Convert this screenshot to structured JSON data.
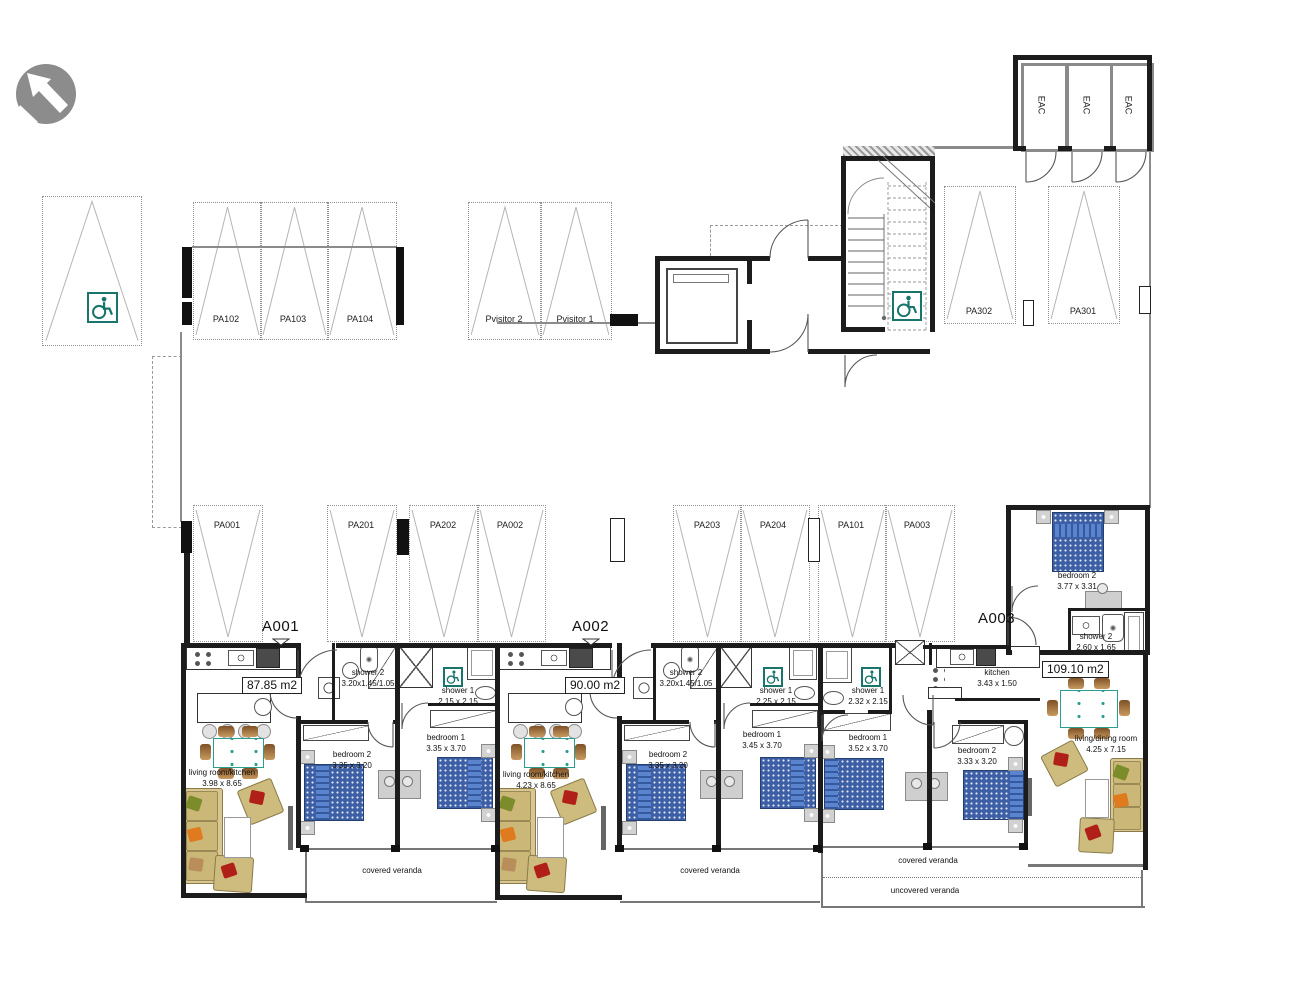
{
  "title": "ground floor plan with parking and apartments",
  "colors": {
    "accessible_teal": "#17756b",
    "bed_blue": "#3d5fa5",
    "pillow_blue": "#5b84cf",
    "sofa_tan": "#d9c690",
    "table_teal": "#2a9d8f",
    "wall_black": "#1c1c1c",
    "logo_gray": "#8c8c8c"
  },
  "parking": {
    "top_row": {
      "pa102": "PA102",
      "pa103": "PA103",
      "pa104": "PA104",
      "pvisitor2": "Pvisitor 2",
      "pvisitor1": "Pvisitor 1",
      "pa302": "PA302",
      "pa301": "PA301"
    },
    "middle_row": {
      "pa001": "PA001",
      "pa201": "PA201",
      "pa202": "PA202",
      "pa002": "PA002",
      "pa203": "PA203",
      "pa204": "PA204",
      "pa101": "PA101",
      "pa003": "PA003"
    }
  },
  "storage": {
    "eac1": "EAC",
    "eac2": "EAC",
    "eac3": "EAC"
  },
  "apartments": {
    "a001": {
      "id": "A001",
      "area": "87.85 m2",
      "living": {
        "name": "living room/kitchen",
        "dims": "3.98 x 8.65"
      },
      "bedroom2": {
        "name": "bedroom 2",
        "dims": "3.35 x 3.20"
      },
      "bedroom1": {
        "name": "bedroom 1",
        "dims": "3.35 x 3.70"
      },
      "shower2": {
        "name": "shower 2",
        "dims": "3.20x1.45/1.05"
      },
      "shower1": {
        "name": "shower 1",
        "dims": "2.15 x 2.15"
      },
      "veranda": "covered veranda"
    },
    "a002": {
      "id": "A002",
      "area": "90.00 m2",
      "living": {
        "name": "living room/kitchen",
        "dims": "4.23 x 8.65"
      },
      "bedroom2": {
        "name": "bedroom 2",
        "dims": "3.35 x 3.20"
      },
      "bedroom1": {
        "name": "bedroom 1",
        "dims": "3.45 x 3.70"
      },
      "shower2": {
        "name": "shower 2",
        "dims": "3.20x1.45/1.05"
      },
      "shower1": {
        "name": "shower 1",
        "dims": "2.25 x 2.15"
      },
      "veranda": "covered veranda"
    },
    "a003": {
      "id": "A003",
      "area": "109.10 m2",
      "kitchen": {
        "name": "kitchen",
        "dims": "3.43 x 1.50"
      },
      "living": {
        "name": "living/dining room",
        "dims": "4.25 x 7.15"
      },
      "bedroom1": {
        "name": "bedroom 1",
        "dims": "3.52 x 3.70"
      },
      "bedroom2": {
        "name": "bedroom 2",
        "dims": "3.33 x 3.20"
      },
      "bedroom2_annex": {
        "name": "bedroom 2",
        "dims": "3.77 x 3.31"
      },
      "shower1": {
        "name": "shower 1",
        "dims": "2.32 x 2.15"
      },
      "shower2_annex": {
        "name": "shower 2",
        "dims": "2.60 x 1.65"
      },
      "veranda_covered": "covered veranda",
      "veranda_uncovered": "uncovered veranda"
    }
  }
}
